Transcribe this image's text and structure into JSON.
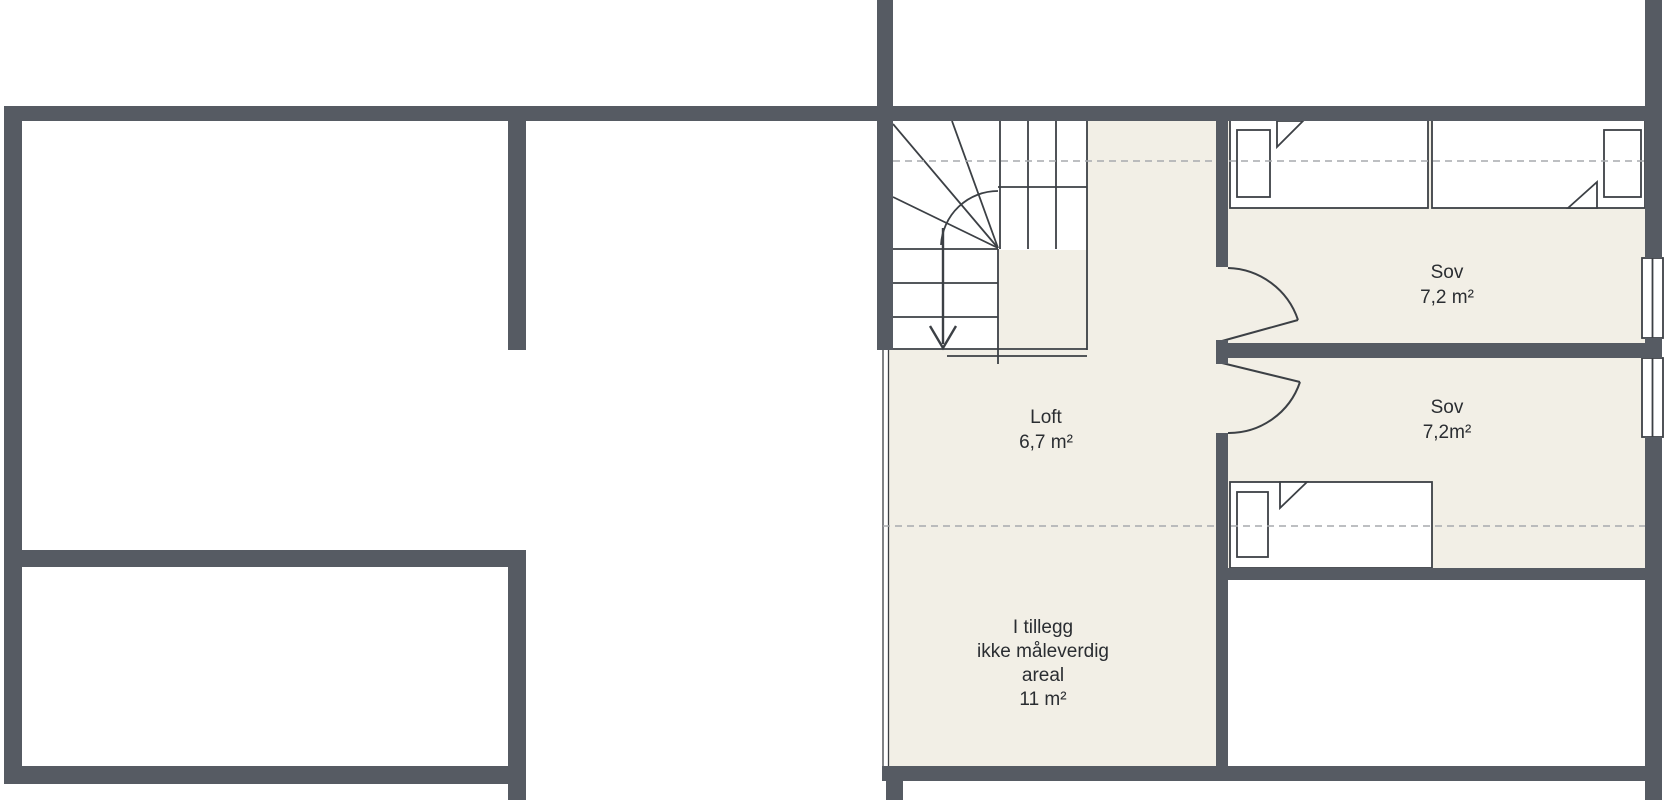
{
  "colors": {
    "wall": "#565b63",
    "floor": "#f2efe6",
    "line": "#3c4045",
    "dashed": "#a7aaad",
    "text": "#2a2d31"
  },
  "rooms": {
    "loft": {
      "name": "Loft",
      "area": "6,7 m²"
    },
    "sov1": {
      "name": "Sov",
      "area": "7,2 m²"
    },
    "sov2": {
      "name": "Sov",
      "area": "7,2m²"
    },
    "tillegg": {
      "line1": "I tillegg",
      "line2": "ikke måleverdig",
      "line3": "areal",
      "line4": "11 m²"
    }
  }
}
